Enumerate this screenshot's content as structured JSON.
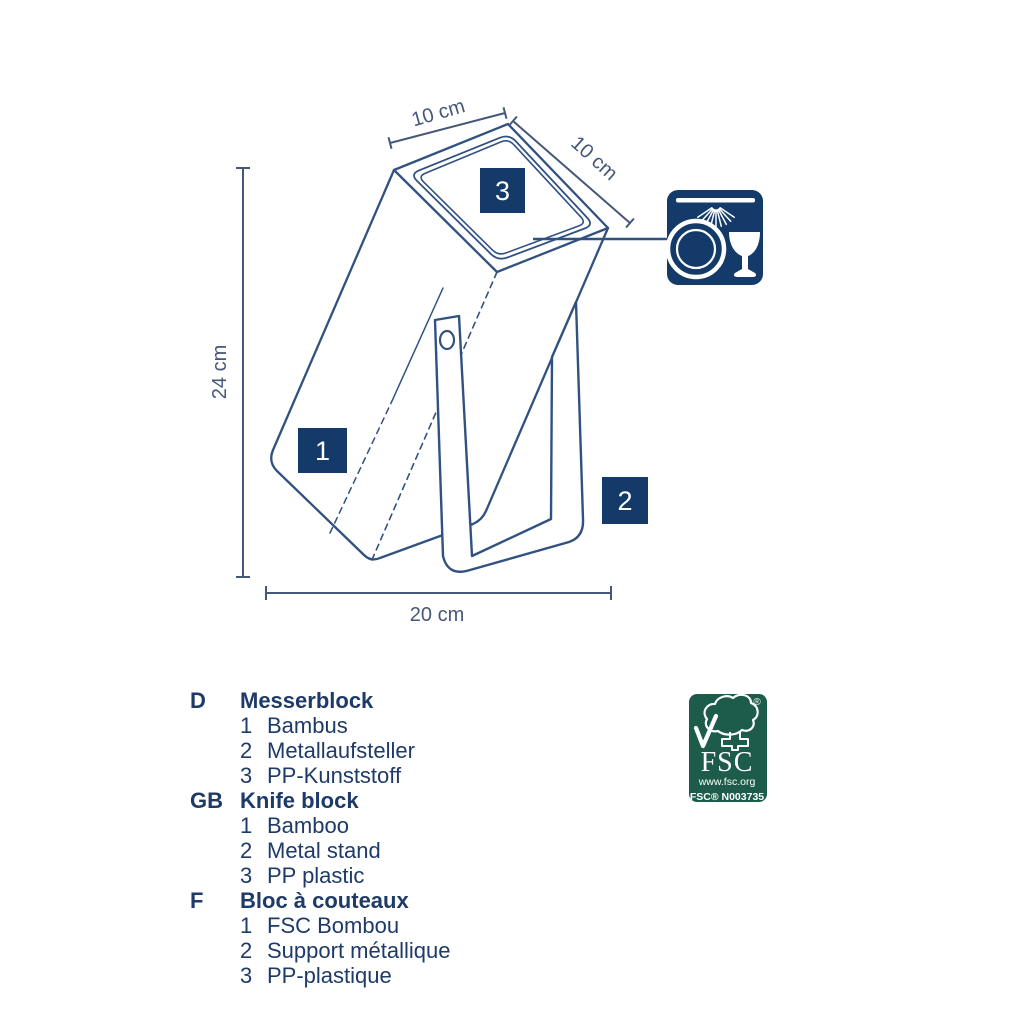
{
  "colors": {
    "navy_fill": "#133a68",
    "line_navy": "#315181",
    "dim_navy": "#45577a",
    "fsc_green": "#1d5c4b"
  },
  "drawing": {
    "dimensions": {
      "top_width": "10 cm",
      "top_depth": "10 cm",
      "height": "24 cm",
      "base_width": "20 cm"
    },
    "part_labels": {
      "body": "1",
      "stand": "2",
      "insert": "3"
    },
    "icons": [
      "dishwasher-safe-icon",
      "fsc-logo"
    ]
  },
  "fsc": {
    "acronym": "FSC",
    "url": "www.fsc.org",
    "license": "FSC® N003735",
    "reg": "®"
  },
  "legend": {
    "sections": [
      {
        "code": "D",
        "title": "Messerblock",
        "items": [
          {
            "num": "1",
            "text": "Bambus"
          },
          {
            "num": "2",
            "text": "Metallaufsteller"
          },
          {
            "num": "3",
            "text": "PP-Kunststoff"
          }
        ]
      },
      {
        "code": "GB",
        "title": "Knife block",
        "items": [
          {
            "num": "1",
            "text": "Bamboo"
          },
          {
            "num": "2",
            "text": "Metal stand"
          },
          {
            "num": "3",
            "text": "PP plastic"
          }
        ]
      },
      {
        "code": "F",
        "title": "Bloc à couteaux",
        "items": [
          {
            "num": "1",
            "text": "FSC Bombou"
          },
          {
            "num": "2",
            "text": "Support métallique"
          },
          {
            "num": "3",
            "text": "PP-plastique"
          }
        ]
      }
    ]
  }
}
